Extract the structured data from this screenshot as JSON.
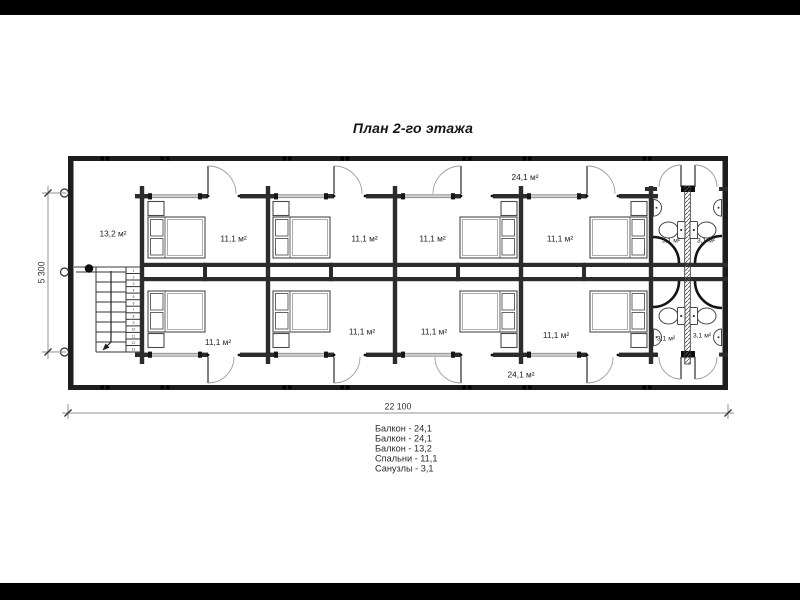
{
  "title": "План 2-го этажа",
  "plan": {
    "balcony_top_label": "24,1 м²",
    "balcony_bottom_label": "24,1 м²",
    "balcony_left_label": "13,2 м²",
    "bedrooms_top": [
      "11,1 м²",
      "11,1 м²",
      "11,1 м²",
      "11,1 м²"
    ],
    "bedrooms_bottom": [
      "11,1 м²",
      "11,1 м²",
      "11,1 м²",
      "11,1 м²"
    ],
    "bathrooms_top": [
      "3,1 м²",
      "3,1 м²"
    ],
    "bathrooms_bottom": [
      "3,1 м²",
      "3,1 м²"
    ],
    "dimensions": {
      "overall_width": "22 100",
      "overall_depth": "5 300"
    },
    "stairs": {
      "steps": [
        "1",
        "2",
        "3",
        "4",
        "5",
        "6",
        "7",
        "8",
        "9",
        "10",
        "11",
        "12",
        "13"
      ]
    }
  },
  "legend": {
    "items": [
      "Балкон - 24,1",
      "Балкон - 24,1",
      "Балкон - 13,2",
      "Спальни - 11,1",
      "Санузлы - 3,1"
    ]
  }
}
